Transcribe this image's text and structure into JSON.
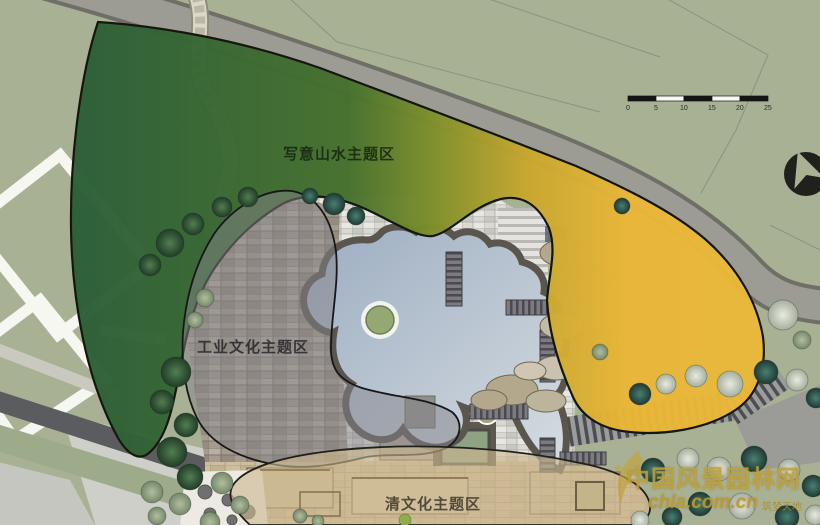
{
  "map": {
    "background_color": "#a9b195",
    "road_color": "#9c9c94",
    "lake_color": "#9cadc1",
    "zones": {
      "shanshui": {
        "label": "写意山水主题区",
        "gradient_start": "#2a5e37",
        "gradient_mid": "#7d8f2b",
        "gradient_end": "#e9b637"
      },
      "industrial": {
        "label": "工业文化主题区",
        "fill": "#85848a"
      },
      "qing": {
        "label": "清文化主题区",
        "fill": "#cdb88f"
      }
    },
    "scale_bar": {
      "ticks": [
        "0",
        "5",
        "10",
        "15",
        "20",
        "25"
      ]
    }
  },
  "watermark": {
    "site_name": "中国风景园林网",
    "url": "chla.com.cn",
    "tagline": "筑梦天地",
    "color": "#bfa23f"
  }
}
